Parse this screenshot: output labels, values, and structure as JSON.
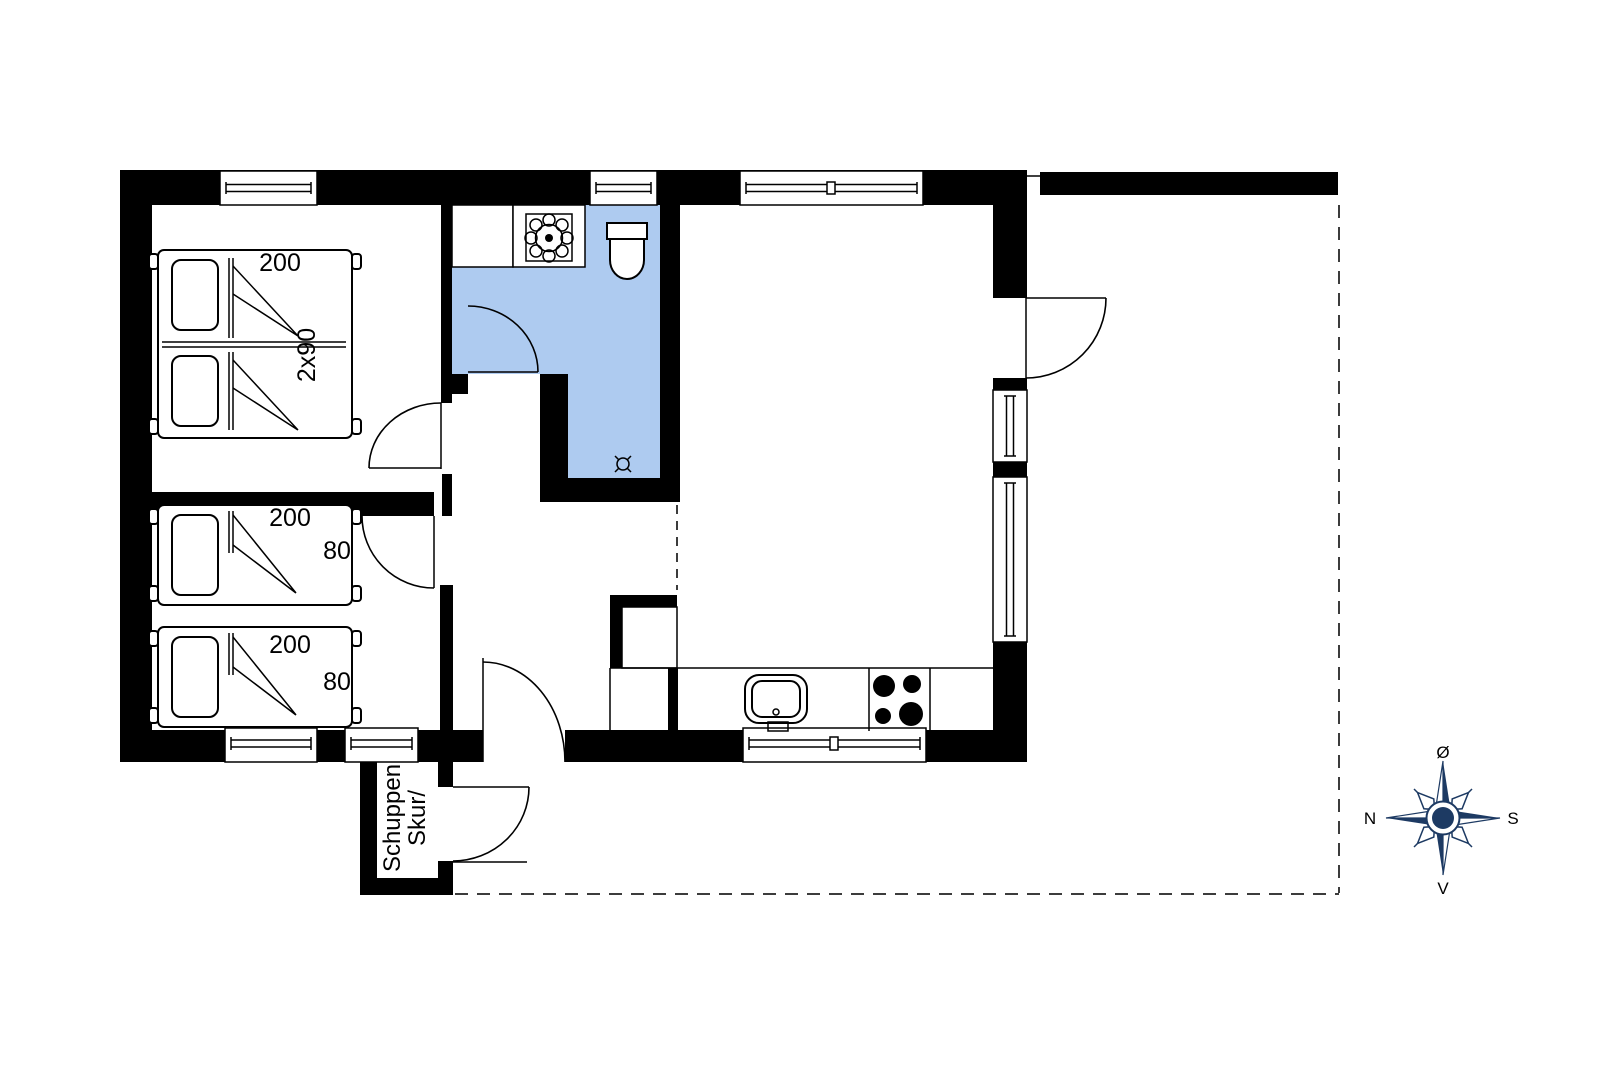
{
  "colors": {
    "wall": "#000000",
    "bathroom_floor": "#aecbf0",
    "compass": "#1d3a63"
  },
  "labels": {
    "double_bed_length": "200",
    "double_bed_width": "2x90",
    "single_bed_1_length": "200",
    "single_bed_1_width": "80",
    "single_bed_2_length": "200",
    "single_bed_2_width": "80",
    "shed_line1": "Skur/",
    "shed_line2": "Schuppen"
  },
  "compass": {
    "top_label": "Ø",
    "left_label": "N",
    "right_label": "S",
    "bottom_label": "V"
  }
}
